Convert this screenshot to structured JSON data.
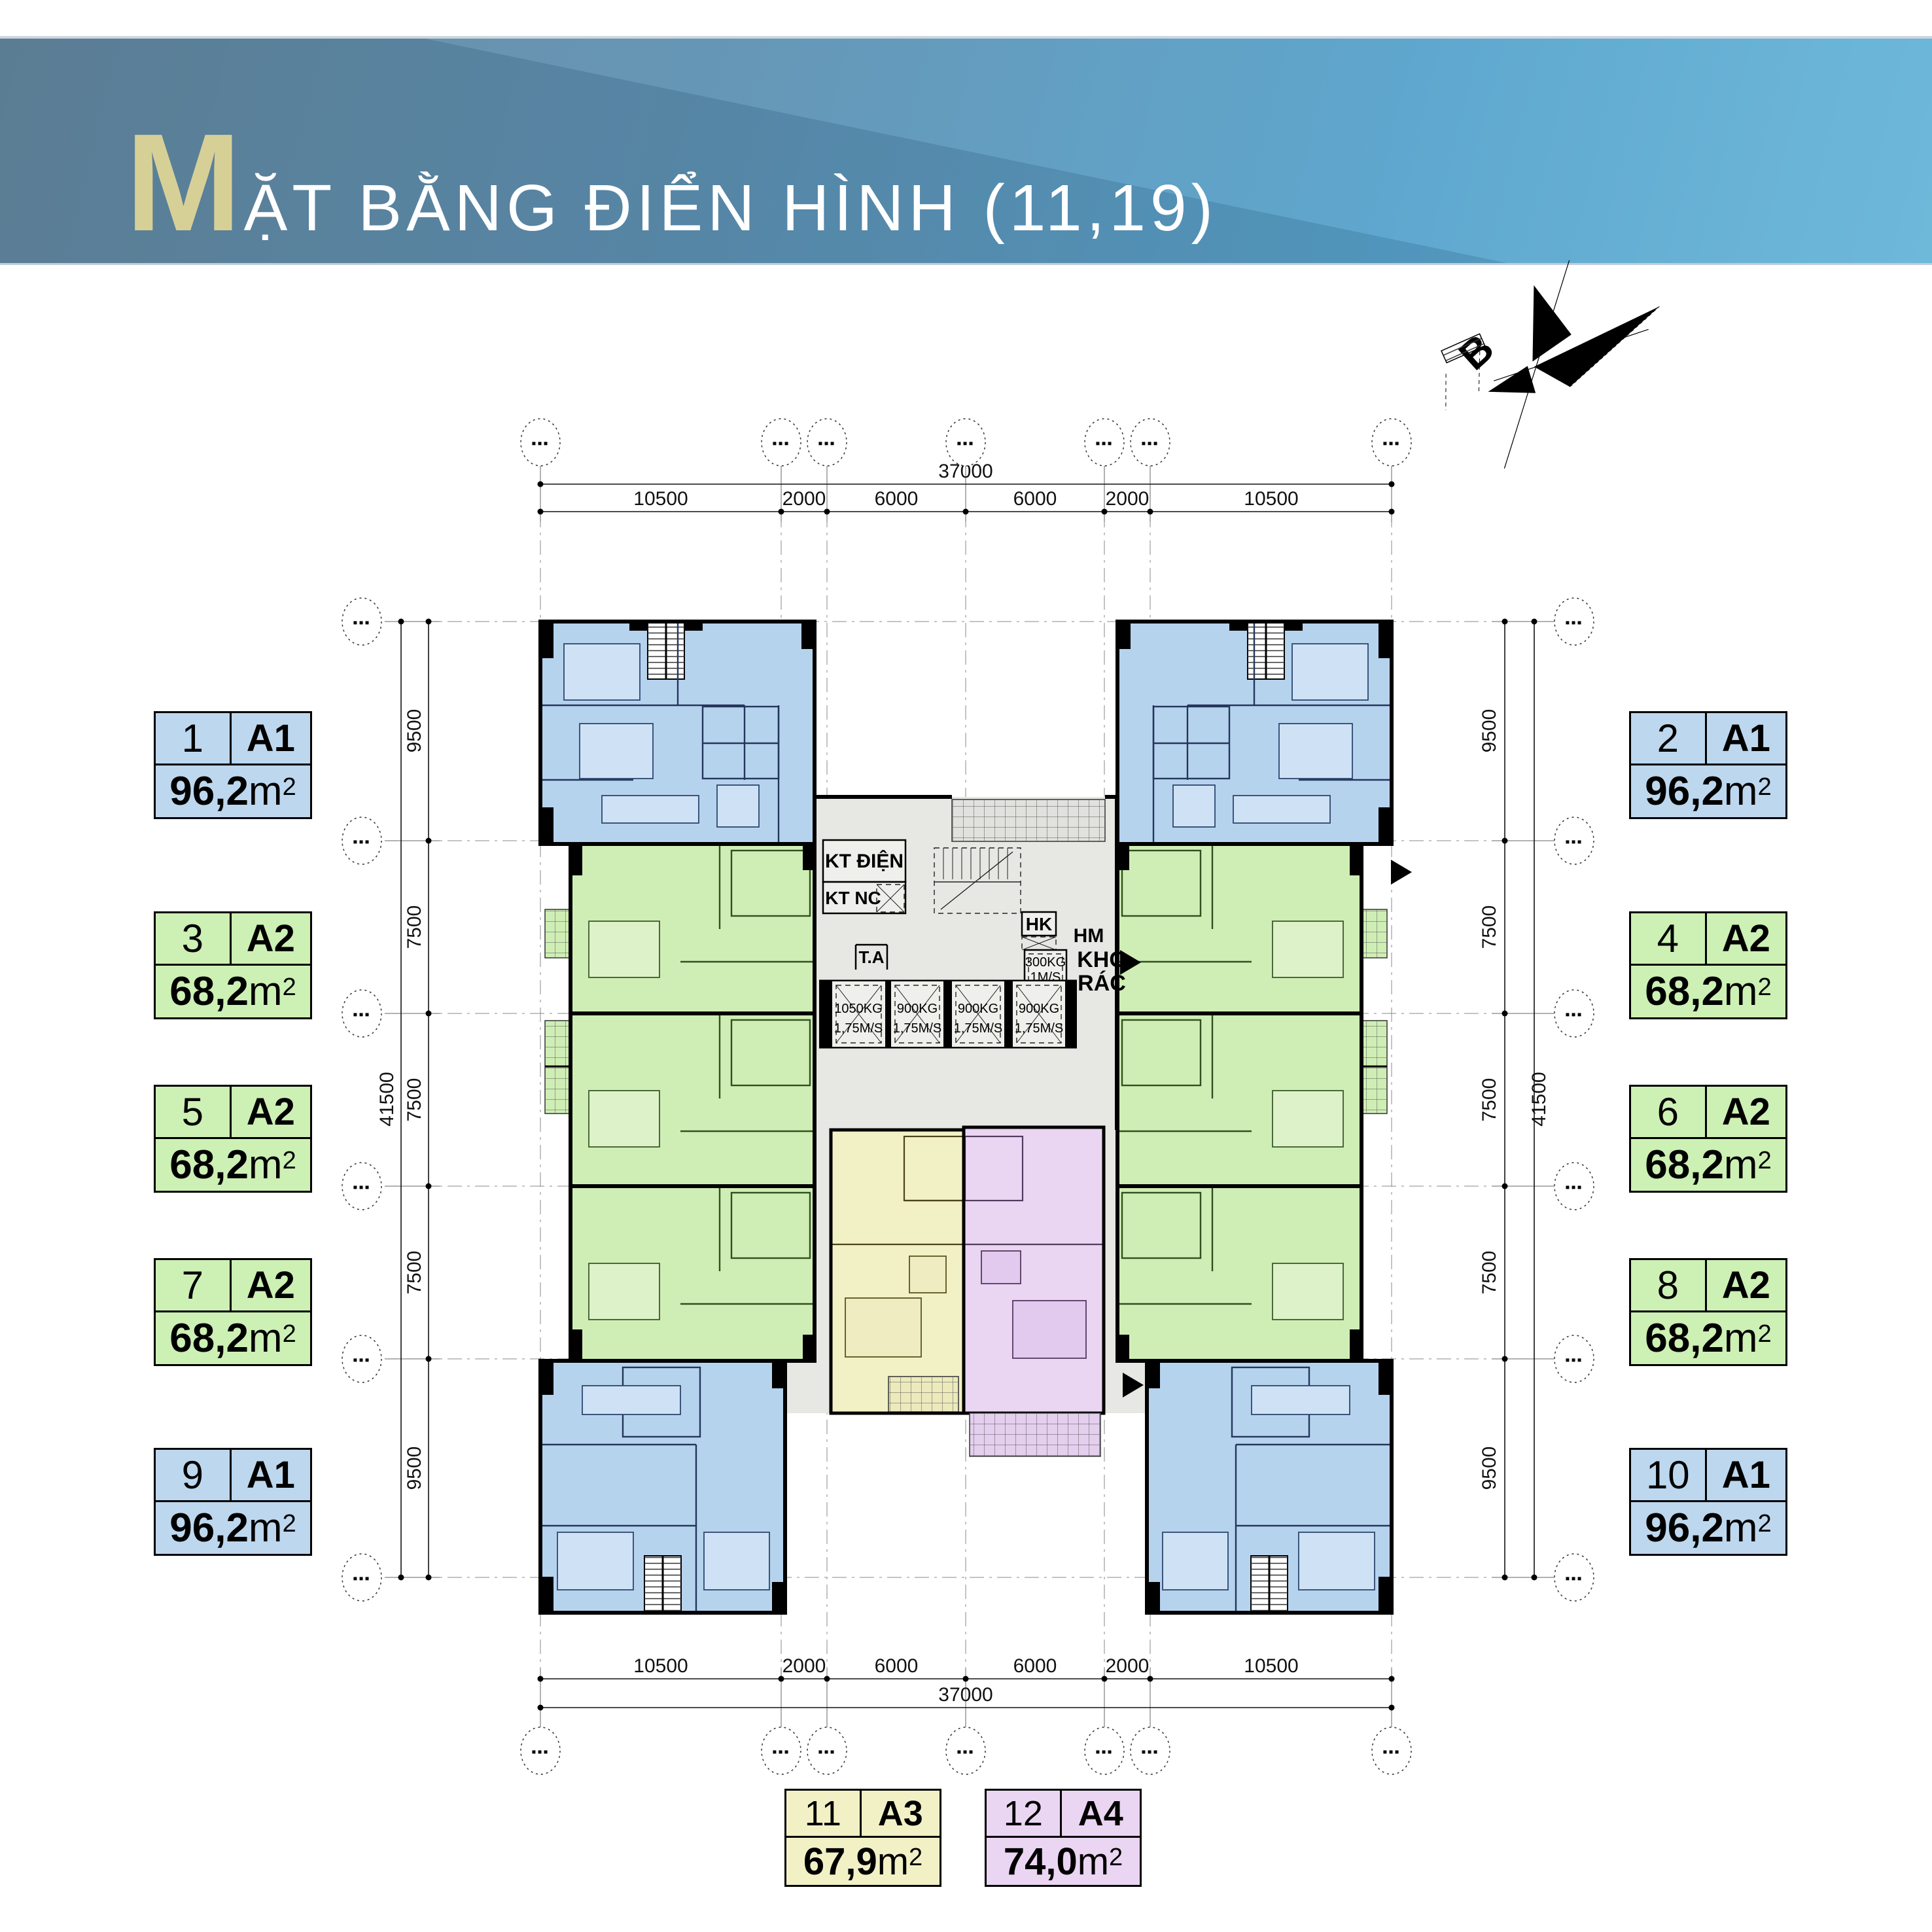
{
  "header": {
    "title_initial": "M",
    "title_rest": "ẶT BẰNG ĐIỂN HÌNH (11,19)"
  },
  "north": {
    "label": "B"
  },
  "dims": {
    "bubble": "▪▪▪",
    "h_total": "37000",
    "h_segments": [
      "10500",
      "2000",
      "6000",
      "6000",
      "2000",
      "10500"
    ],
    "v_total": "41500",
    "v_segments": [
      "9500",
      "7500",
      "7500",
      "7500",
      "9500"
    ]
  },
  "core": {
    "kt_dien": "KT ĐIỆN",
    "kt_nc": "KT NC",
    "ta": "T.A",
    "hk": "HK",
    "hm": "HM",
    "kho_line1": "KHO",
    "kho_line2": "RÁC",
    "hoist": {
      "capacity": "300KG",
      "speed": "1M/S"
    },
    "elevators": [
      {
        "capacity": "1050KG",
        "speed": "1,75M/S"
      },
      {
        "capacity": "900KG",
        "speed": "1,75M/S"
      },
      {
        "capacity": "900KG",
        "speed": "1,75M/S"
      },
      {
        "capacity": "900KG",
        "speed": "1,75M/S"
      }
    ]
  },
  "units": [
    {
      "no": "1",
      "type": "A1",
      "area": "96,2",
      "area_unit": "m",
      "area_sup": "2"
    },
    {
      "no": "2",
      "type": "A1",
      "area": "96,2",
      "area_unit": "m",
      "area_sup": "2"
    },
    {
      "no": "3",
      "type": "A2",
      "area": "68,2",
      "area_unit": "m",
      "area_sup": "2"
    },
    {
      "no": "4",
      "type": "A2",
      "area": "68,2",
      "area_unit": "m",
      "area_sup": "2"
    },
    {
      "no": "5",
      "type": "A2",
      "area": "68,2",
      "area_unit": "m",
      "area_sup": "2"
    },
    {
      "no": "6",
      "type": "A2",
      "area": "68,2",
      "area_unit": "m",
      "area_sup": "2"
    },
    {
      "no": "7",
      "type": "A2",
      "area": "68,2",
      "area_unit": "m",
      "area_sup": "2"
    },
    {
      "no": "8",
      "type": "A2",
      "area": "68,2",
      "area_unit": "m",
      "area_sup": "2"
    },
    {
      "no": "9",
      "type": "A1",
      "area": "96,2",
      "area_unit": "m",
      "area_sup": "2"
    },
    {
      "no": "10",
      "type": "A1",
      "area": "96,2",
      "area_unit": "m",
      "area_sup": "2"
    },
    {
      "no": "11",
      "type": "A3",
      "area": "67,9",
      "area_unit": "m",
      "area_sup": "2"
    },
    {
      "no": "12",
      "type": "A4",
      "area": "74,0",
      "area_unit": "m",
      "area_sup": "2"
    }
  ],
  "colors": {
    "a1": "#bdd7ee",
    "a2": "#cdf0b4",
    "a3": "#f2f1c6",
    "a4": "#ead5f2",
    "banner_gold": "#d7d096",
    "core_gray": "#e7e7e3"
  }
}
